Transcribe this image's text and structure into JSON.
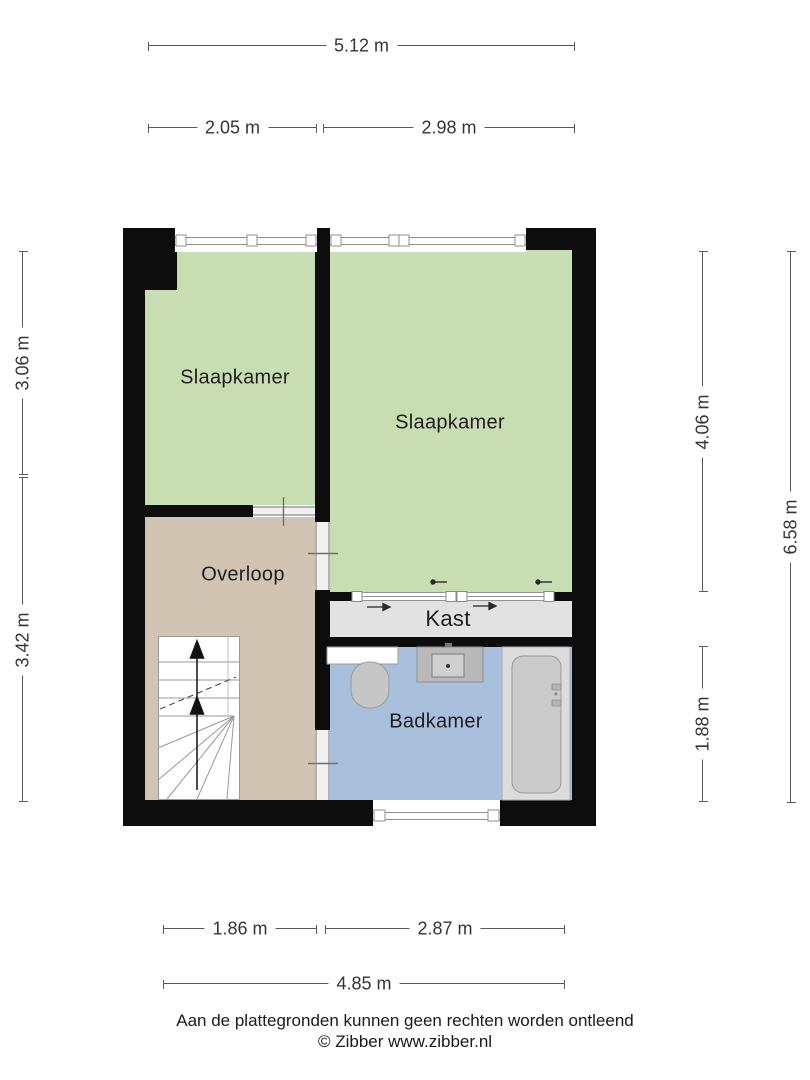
{
  "plan": {
    "rooms": {
      "bedroom_left": {
        "label": "Slaapkamer"
      },
      "bedroom_right": {
        "label": "Slaapkamer"
      },
      "landing": {
        "label": "Overloop"
      },
      "closet": {
        "label": "Kast"
      },
      "bathroom": {
        "label": "Badkamer"
      }
    },
    "icons": {
      "stairs": "stairs-icon",
      "stairs_direction": "up-arrow-icon",
      "toilet": "toilet-icon",
      "sink": "sink-icon",
      "bathtub": "bathtub-icon",
      "sliding_door": "sliding-door-icon",
      "door_opening": "door-opening-icon",
      "window": "window-icon"
    },
    "colors": {
      "bedroom_fill": "#c8deb2",
      "landing_fill": "#d1c4b2",
      "bathroom_fill": "#a8c0dc",
      "closet_fill": "#e2e2e2",
      "wall": "#0d0d0d",
      "dimension_line": "#5a5a5a",
      "label_text": "#1e1e1e"
    }
  },
  "dimensions": {
    "top": {
      "total": "5.12 m",
      "left": "2.05 m",
      "right": "2.98 m"
    },
    "left": {
      "upper": "3.06 m",
      "lower": "3.42 m"
    },
    "right": {
      "upper": "4.06 m",
      "lower": "1.88 m",
      "total": "6.58 m"
    },
    "bottom": {
      "left": "1.86 m",
      "right": "2.87 m",
      "total": "4.85 m"
    }
  },
  "footer": {
    "disclaimer": "Aan de plattegronden kunnen geen rechten worden ontleend",
    "copyright": "© Zibber www.zibber.nl"
  }
}
